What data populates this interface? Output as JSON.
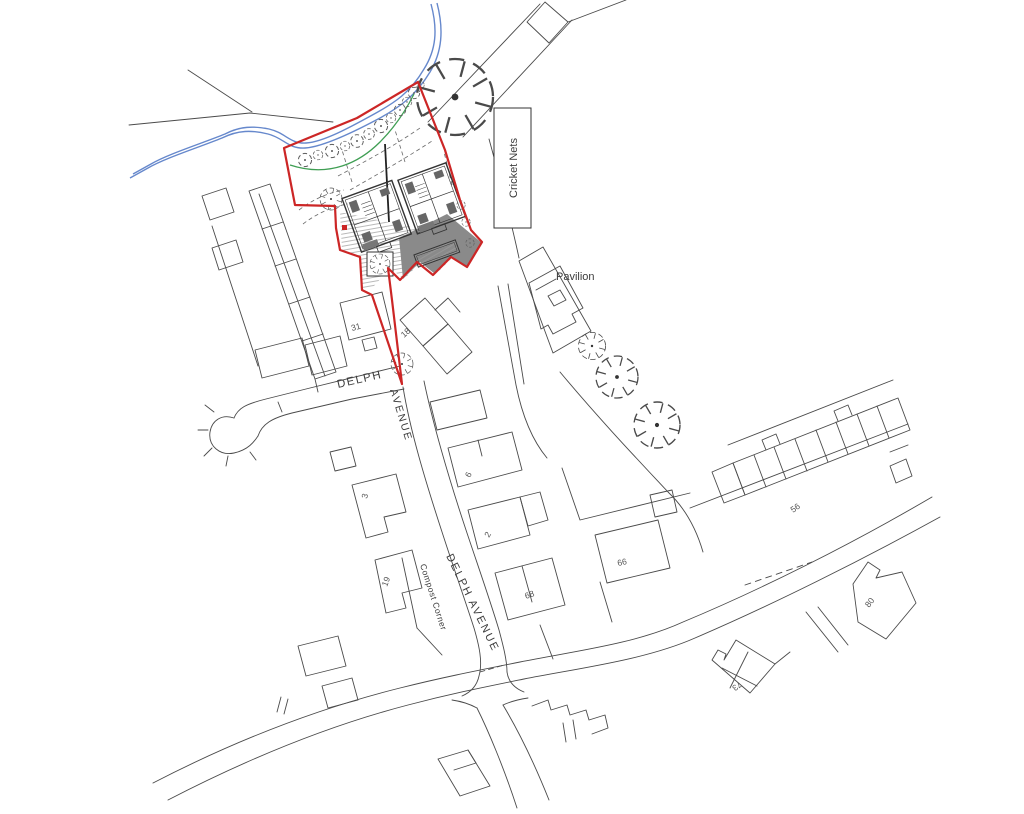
{
  "drawing_type": "site-location-plan",
  "colors": {
    "site_boundary_red": "#cc2626",
    "stream_blue": "#6688cc",
    "landscape_green": "#3f9e53",
    "linework_grey": "#4a4a4a",
    "driveway_grey": "#8a8a8a"
  },
  "labels": {
    "cricket_nets": {
      "text": "Cricket Nets"
    },
    "pavilion": {
      "text": "Pavilion"
    },
    "delph": {
      "text": "DELPH"
    },
    "avenue": {
      "text": "AVENUE"
    },
    "delph_avenue": {
      "text": "DELPH AVENUE"
    },
    "compost_corner": {
      "text": "Compost Corner"
    },
    "house_numbers": {
      "n31": "31",
      "n18": "18",
      "n3": "3",
      "n6": "6",
      "n2": "2",
      "n19": "19",
      "n68": "68",
      "n66": "66",
      "n56": "56",
      "n80": "80",
      "n73": "73"
    }
  }
}
